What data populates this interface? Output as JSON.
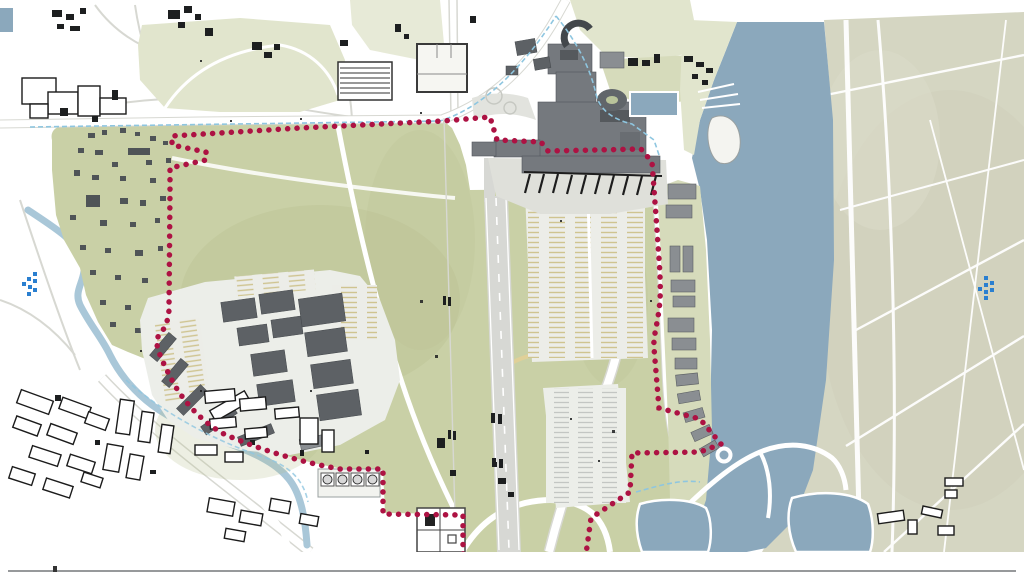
{
  "page": {
    "title": "airport-masterplan-site-map",
    "width_px": 1024,
    "height_px": 576
  },
  "colors": {
    "background": "#ffffff",
    "site_green": "#c9d0a6",
    "site_green_light": "#d6dbbb",
    "park_green": "#e1e5cd",
    "khaki": "#d5d6c2",
    "water": "#8ba8bc",
    "river": "#a9c7d8",
    "road_white": "#ffffff",
    "road_gray": "#d7d8d2",
    "apron": "#eceee9",
    "runway_gray": "#d7d8d4",
    "terminal_gray": "#75797e",
    "building_dark": "#5d6165",
    "building_mid": "#8a8e92",
    "building_outline": "#1b1b1b",
    "boundary_red": "#ad1243",
    "boundary_blue_dash": "#8ec6e0",
    "stall_tan": "#cfc490",
    "stall_gray": "#c3c6c3",
    "marker_blue": "#2a7fd0",
    "divider_gray": "#97999b",
    "yellow_road": "#e0d098"
  },
  "map": {
    "type": "illustrated-site-plan",
    "features": [
      {
        "id": "site-boundary",
        "kind": "dotted-line",
        "color_key": "boundary_red"
      },
      {
        "id": "secondary-boundary",
        "kind": "dashed-line",
        "color_key": "boundary_blue_dash"
      },
      {
        "id": "runway",
        "kind": "paved-strip"
      },
      {
        "id": "terminal-complex",
        "kind": "buildings"
      },
      {
        "id": "pier-gates",
        "kind": "jetty-comb",
        "gate_count": 10
      },
      {
        "id": "cargo-warehouses",
        "kind": "buildings"
      },
      {
        "id": "parking-lots",
        "kind": "parking"
      },
      {
        "id": "fuel-tank-farm",
        "kind": "tanks",
        "tank_count": 4
      },
      {
        "id": "harbor-channel",
        "kind": "water"
      },
      {
        "id": "harbor-basin",
        "kind": "water"
      },
      {
        "id": "river",
        "kind": "water"
      },
      {
        "id": "ponds",
        "kind": "water"
      },
      {
        "id": "city-blocks",
        "kind": "outlined-buildings"
      },
      {
        "id": "cottage-area",
        "kind": "small-buildings"
      },
      {
        "id": "farm-fields",
        "kind": "khaki-land"
      }
    ],
    "markers": [
      {
        "id": "left-blue-marker",
        "shape": "pixel-chevron",
        "direction": "left",
        "color_key": "marker_blue"
      },
      {
        "id": "right-blue-marker",
        "shape": "pixel-chevron",
        "direction": "right",
        "color_key": "marker_blue"
      }
    ]
  },
  "footer": {
    "divider_line": true
  }
}
